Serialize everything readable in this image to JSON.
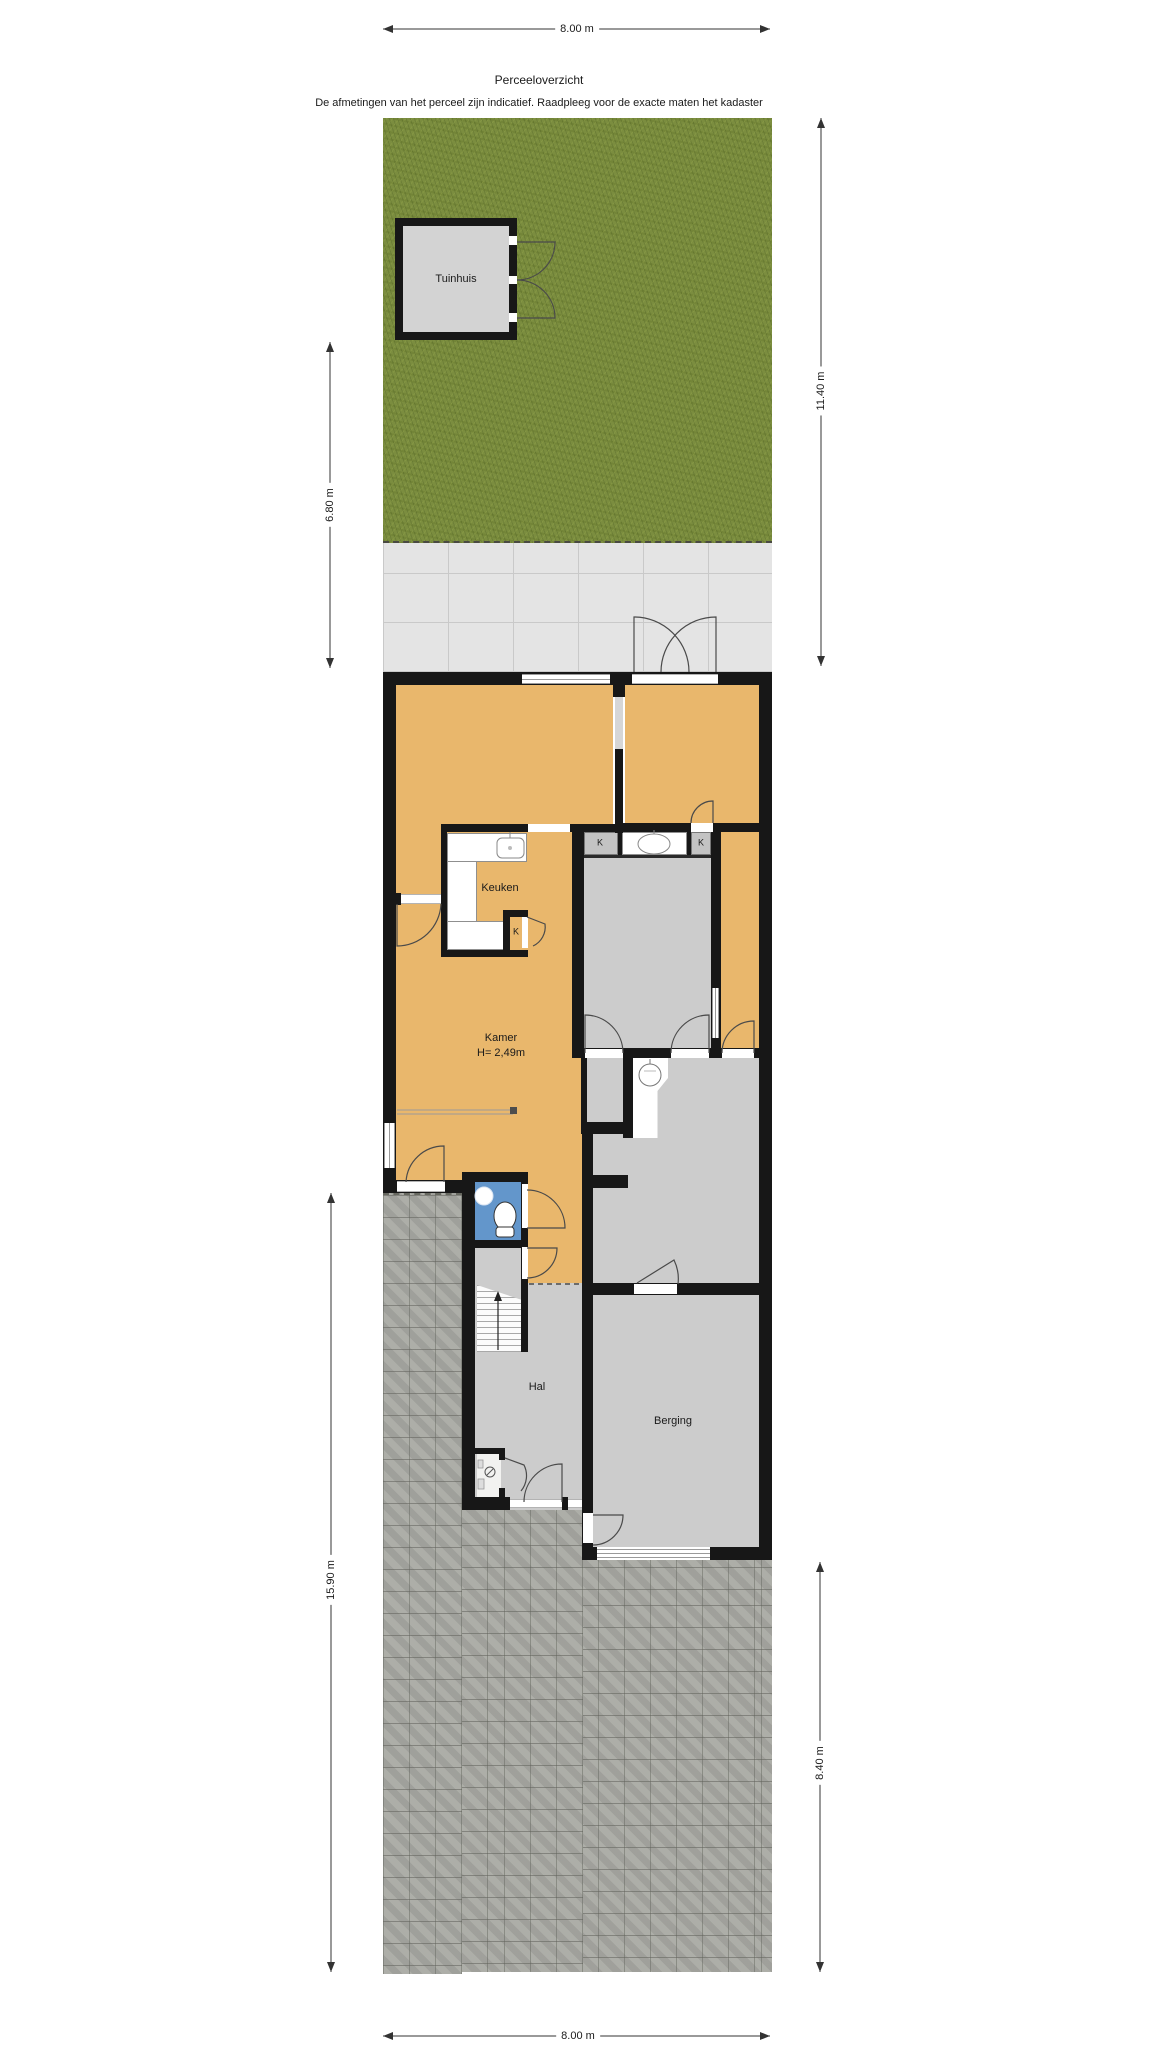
{
  "header": {
    "title": "Perceeloverzicht",
    "disclaimer": "De afmetingen van het perceel zijn indicatief. Raadpleeg voor de exacte maten het kadaster"
  },
  "dimensions": {
    "top": "8.00 m",
    "upper_right": "11.40 m",
    "upper_left": "6.80 m",
    "lower_left": "15.90 m",
    "lower_right": "8.40 m",
    "bottom": "8.00 m"
  },
  "rooms": {
    "tuinhuis": "Tuinhuis",
    "keuken": "Keuken",
    "kamer": "Kamer",
    "kamer_height": "H= 2,49m",
    "hal": "Hal",
    "berging": "Berging"
  },
  "closets": {
    "kitchen": "K",
    "left": "K",
    "right": "K"
  },
  "colors": {
    "grass": "#7b8d3f",
    "paving": "#a8a9a3",
    "patio": "#e4e4e4",
    "patio_joint": "#c9c9c9",
    "floor": "#e9b76c",
    "room_gray": "#cccccc",
    "closet_gray": "#c3c3c3",
    "toilet_blue": "#6396cb",
    "wall": "#171717",
    "shed_gray": "#d3d3d3"
  }
}
